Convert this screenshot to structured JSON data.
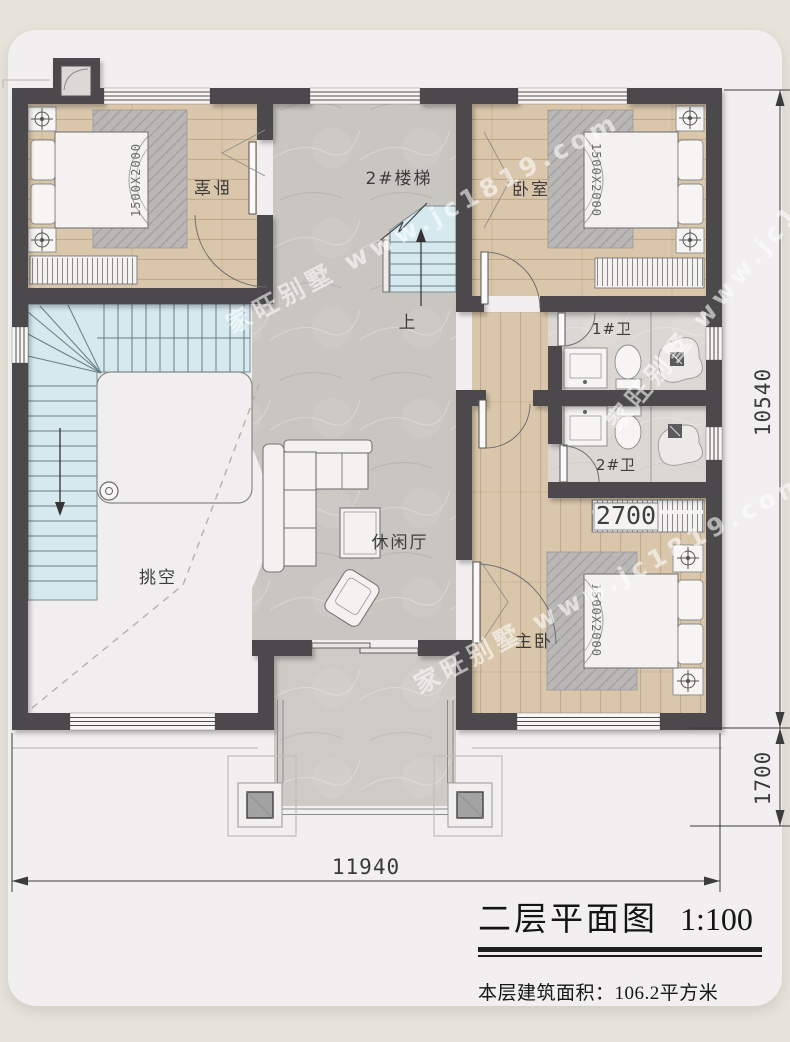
{
  "page": {
    "background": "#e7e3da",
    "card_color": "#f1eff0"
  },
  "plan": {
    "rooms": {
      "bedroom_left": "卧室",
      "bedroom_right": "卧室",
      "master_bedroom": "主卧",
      "stair_2": "2#楼梯",
      "stair_up": "上",
      "bath_1": "1#卫",
      "bath_2": "2#卫",
      "void": "挑空",
      "lounge": "休闲厅"
    },
    "furniture_labels": {
      "bed_size": "1500X2000",
      "wardrobe_width": "2700"
    },
    "dimensions": {
      "overall_width": "11940",
      "overall_height": "10540",
      "porch_depth": "1700"
    },
    "watermark_text": "家旺别墅 www.jc1819.com",
    "colors": {
      "wall": "#4b4a4c",
      "wood": "#d9c6aa",
      "stone": "#c9c5c0",
      "stair": "#d5e9ee",
      "rug": "#bab8b6"
    }
  },
  "title_block": {
    "title": "二层平面图",
    "scale": "1:100",
    "area_text": "本层建筑面积：106.2平方米"
  }
}
